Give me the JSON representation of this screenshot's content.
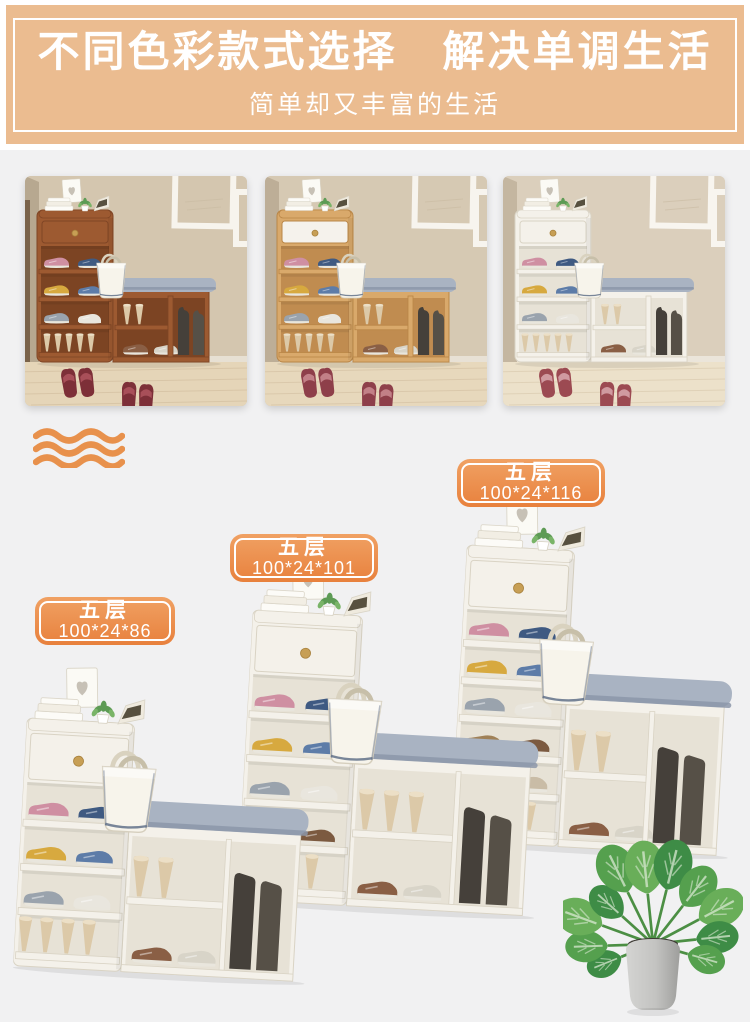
{
  "banner": {
    "title": "不同色彩款式选择　解决单调生活",
    "subtitle": "简单却又丰富的生活",
    "background_color": "#ebbc90",
    "text_color": "#ffffff"
  },
  "decor": {
    "wave_color": "#e8914c"
  },
  "badge_style": {
    "background_color": "#e8813d",
    "border_color": "#ffffff",
    "text_color": "#ffffff"
  },
  "color_options": [
    {
      "id": "red-brown-wood",
      "cabinet_color": "#9d5a31",
      "drawer_color": "#9d5a31",
      "interior_color": "#7c4423",
      "edge_color": "#7f4525",
      "slipper_color": "#7d2f38",
      "slipper_band_color": "#a84f59"
    },
    {
      "id": "oak-wood",
      "cabinet_color": "#d9a96b",
      "drawer_color": "#f5f2ec",
      "interior_color": "#c08c50",
      "edge_color": "#b98647",
      "slipper_color": "#8e3f4a",
      "slipper_band_color": "#c28087"
    },
    {
      "id": "white",
      "cabinet_color": "#f4f1ea",
      "drawer_color": "#f4f1ea",
      "interior_color": "#e7e2d6",
      "edge_color": "#d9d3c4",
      "slipper_color": "#9c4a52",
      "slipper_band_color": "#d09aa0"
    }
  ],
  "size_options": [
    {
      "tier": "五层",
      "dimensions": "100*24*86"
    },
    {
      "tier": "五层",
      "dimensions": "100*24*101"
    },
    {
      "tier": "五层",
      "dimensions": "100*24*116"
    }
  ],
  "product_style": {
    "body_color": "#f4f1ea",
    "cushion_color": "#a9b3c2"
  }
}
